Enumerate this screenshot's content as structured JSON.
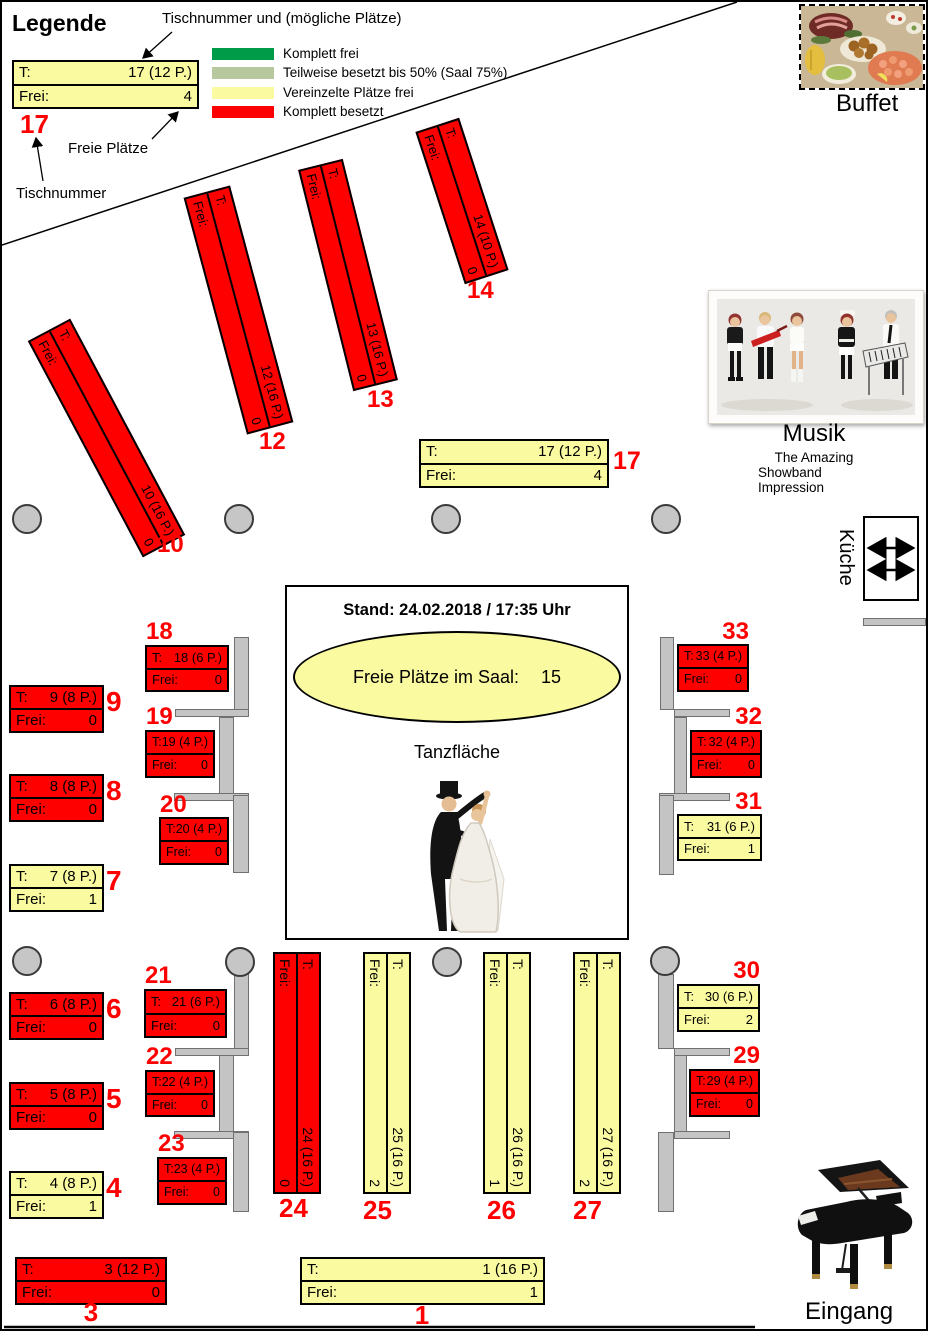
{
  "legend": {
    "title": "Legende",
    "annotation_top": "Tischnummer und (mögliche Plätze)",
    "annotation_free_seats": "Freie Plätze",
    "annotation_table_number": "Tischnummer",
    "example_table": {
      "number": "17",
      "row1_label": "T:",
      "row1_value": "17 (12 P.)",
      "row2_label": "Frei:",
      "row2_value": "4",
      "status": "some_free"
    },
    "items": [
      {
        "label": "Komplett frei",
        "color": "#009B48",
        "status": "all_free"
      },
      {
        "label": "Teilweise besetzt bis 50% (Saal 75%)",
        "color": "#B7C89E",
        "status": "half_free"
      },
      {
        "label": "Vereinzelte Plätze frei",
        "color": "#FAFAA0",
        "status": "some_free"
      },
      {
        "label": "Komplett besetzt",
        "color": "#FF0000",
        "status": "occupied"
      }
    ]
  },
  "status_colors": {
    "all_free": "#009B48",
    "half_free": "#B7C89E",
    "some_free": "#FAFAA0",
    "occupied": "#FF0000"
  },
  "info": {
    "stand": "Stand: 24.02.2018 / 17:35 Uhr",
    "free_seats_label": "Freie Plätze im Saal:",
    "free_seats_value": "15",
    "dance_floor": "Tanzfläche"
  },
  "areas": {
    "buffet": "Buffet",
    "music_title": "Musik",
    "music_band_line1": "The Amazing",
    "music_band_line2": "Showband Impression",
    "kitchen": "Küche",
    "entrance": "Eingang"
  },
  "table_row_labels": {
    "t": "T:",
    "frei": "Frei:"
  },
  "tables": [
    {
      "number": "1",
      "capacity": "1 (16 P.)",
      "free": "1",
      "status": "some_free"
    },
    {
      "number": "3",
      "capacity": "3 (12 P.)",
      "free": "0",
      "status": "occupied"
    },
    {
      "number": "4",
      "capacity": "4 (8 P.)",
      "free": "1",
      "status": "some_free"
    },
    {
      "number": "5",
      "capacity": "5 (8 P.)",
      "free": "0",
      "status": "occupied"
    },
    {
      "number": "6",
      "capacity": "6 (8 P.)",
      "free": "0",
      "status": "occupied"
    },
    {
      "number": "7",
      "capacity": "7 (8 P.)",
      "free": "1",
      "status": "some_free"
    },
    {
      "number": "8",
      "capacity": "8 (8 P.)",
      "free": "0",
      "status": "occupied"
    },
    {
      "number": "9",
      "capacity": "9 (8 P.)",
      "free": "0",
      "status": "occupied"
    },
    {
      "number": "10",
      "capacity": "10 (16 P.)",
      "free": "0",
      "status": "occupied"
    },
    {
      "number": "12",
      "capacity": "12 (16 P.)",
      "free": "0",
      "status": "occupied"
    },
    {
      "number": "13",
      "capacity": "13 (16 P.)",
      "free": "0",
      "status": "occupied"
    },
    {
      "number": "14",
      "capacity": "14 (10 P.)",
      "free": "0",
      "status": "occupied"
    },
    {
      "number": "17",
      "capacity": "17 (12 P.)",
      "free": "4",
      "status": "some_free"
    },
    {
      "number": "18",
      "capacity": "18 (6 P.)",
      "free": "0",
      "status": "occupied"
    },
    {
      "number": "19",
      "capacity": "19 (4 P.)",
      "free": "0",
      "status": "occupied"
    },
    {
      "number": "20",
      "capacity": "20 (4 P.)",
      "free": "0",
      "status": "occupied"
    },
    {
      "number": "21",
      "capacity": "21 (6 P.)",
      "free": "0",
      "status": "occupied"
    },
    {
      "number": "22",
      "capacity": "22 (4 P.)",
      "free": "0",
      "status": "occupied"
    },
    {
      "number": "23",
      "capacity": "23 (4 P.)",
      "free": "0",
      "status": "occupied"
    },
    {
      "number": "24",
      "capacity": "24 (16 P.)",
      "free": "0",
      "status": "occupied"
    },
    {
      "number": "25",
      "capacity": "25 (16 P.)",
      "free": "2",
      "status": "some_free"
    },
    {
      "number": "26",
      "capacity": "26 (16 P.)",
      "free": "1",
      "status": "some_free"
    },
    {
      "number": "27",
      "capacity": "27 (16 P.)",
      "free": "2",
      "status": "some_free"
    },
    {
      "number": "29",
      "capacity": "29 (4 P.)",
      "free": "0",
      "status": "occupied"
    },
    {
      "number": "30",
      "capacity": "30 (6 P.)",
      "free": "2",
      "status": "some_free"
    },
    {
      "number": "31",
      "capacity": "31 (6 P.)",
      "free": "1",
      "status": "some_free"
    },
    {
      "number": "32",
      "capacity": "32 (4 P.)",
      "free": "0",
      "status": "occupied"
    },
    {
      "number": "33",
      "capacity": "33 (4 P.)",
      "free": "0",
      "status": "occupied"
    }
  ]
}
